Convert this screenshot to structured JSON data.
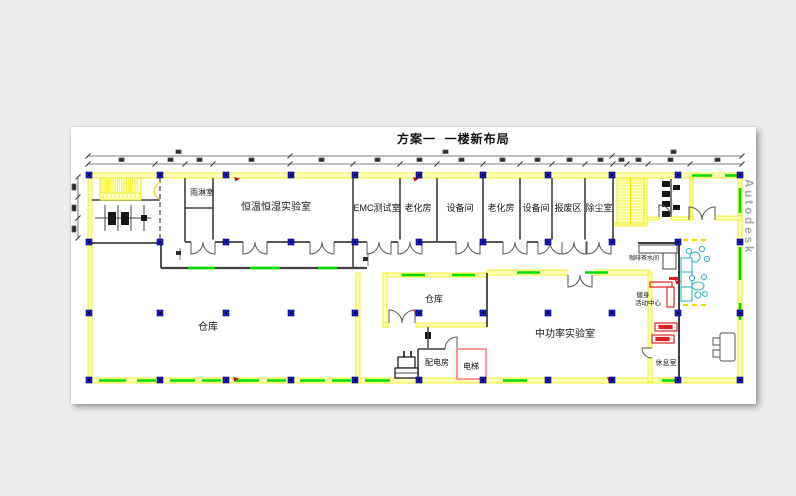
{
  "title": "方案一  一楼新布局",
  "watermark": "Autodesk",
  "rooms": {
    "rain_room": "雨淋室",
    "climate_lab": "恒温恒湿实验室",
    "emc_test": "EMC测试室",
    "aging_room_1": "老化房",
    "equipment_room_1": "设备间",
    "aging_room_2": "老化房",
    "equipment_room_2": "设备间",
    "scrap_area": "报废区",
    "dust_removal": "除尘室",
    "warehouse_main": "仓库",
    "warehouse_small": "仓库",
    "mid_power_lab": "中功率实验室",
    "power_room": "配电房",
    "elevator": "电梯",
    "coffee_room": "咖啡茶水间",
    "fitness_line1": "健身",
    "fitness_line2": "活动中心",
    "lounge": "休息室"
  },
  "colors": {
    "desktop": "#ededed",
    "paper": "#ffffff",
    "wall_yellow": "#efef00",
    "wall_fill": "#ffffbb",
    "wall_dark": "#3f3f3f",
    "window_green": "#00dd00",
    "column_blue": "#1a17c9",
    "accent_red": "#e02020",
    "elevator_red": "#ff9090",
    "furniture_cyan": "#35b6c5",
    "watermark_gray": "#9a9a9a"
  }
}
